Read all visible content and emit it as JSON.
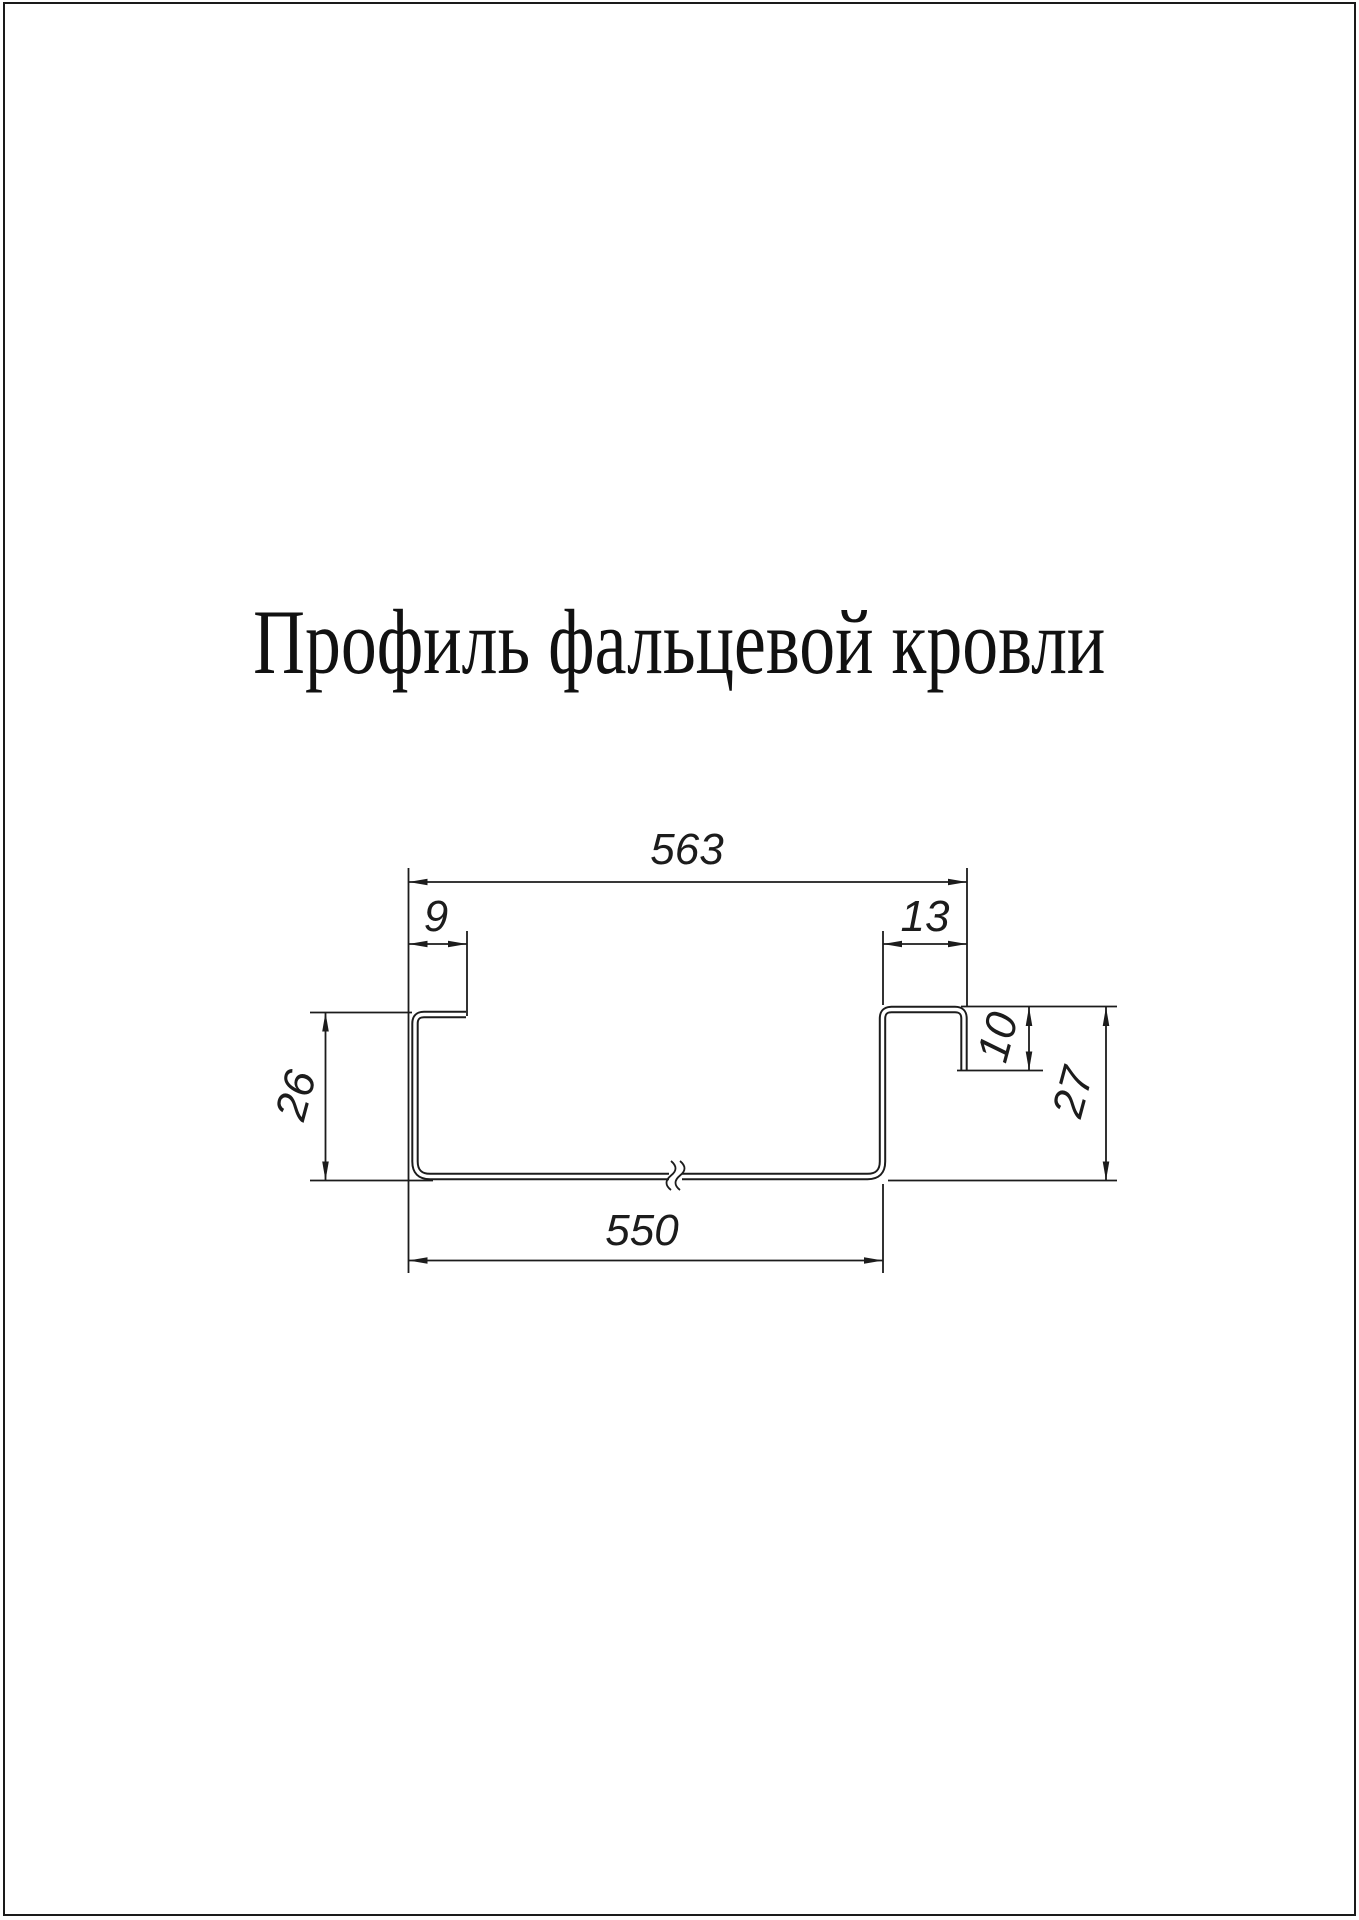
{
  "page": {
    "title": "Профиль фальцевой кровли",
    "background_color": "#ffffff",
    "border_color": "#1a1a1a",
    "line_color": "#1c1c1c"
  },
  "drawing": {
    "description": "standing-seam-roof-profile-cross-section",
    "dimensions": [
      {
        "id": "overall-top-width",
        "label": "563"
      },
      {
        "id": "left-flange-width",
        "label": "9"
      },
      {
        "id": "right-flange-width",
        "label": "13"
      },
      {
        "id": "left-height",
        "label": "26"
      },
      {
        "id": "seam-leg-height",
        "label": "10"
      },
      {
        "id": "right-height",
        "label": "27"
      },
      {
        "id": "bottom-width",
        "label": "550"
      }
    ]
  }
}
